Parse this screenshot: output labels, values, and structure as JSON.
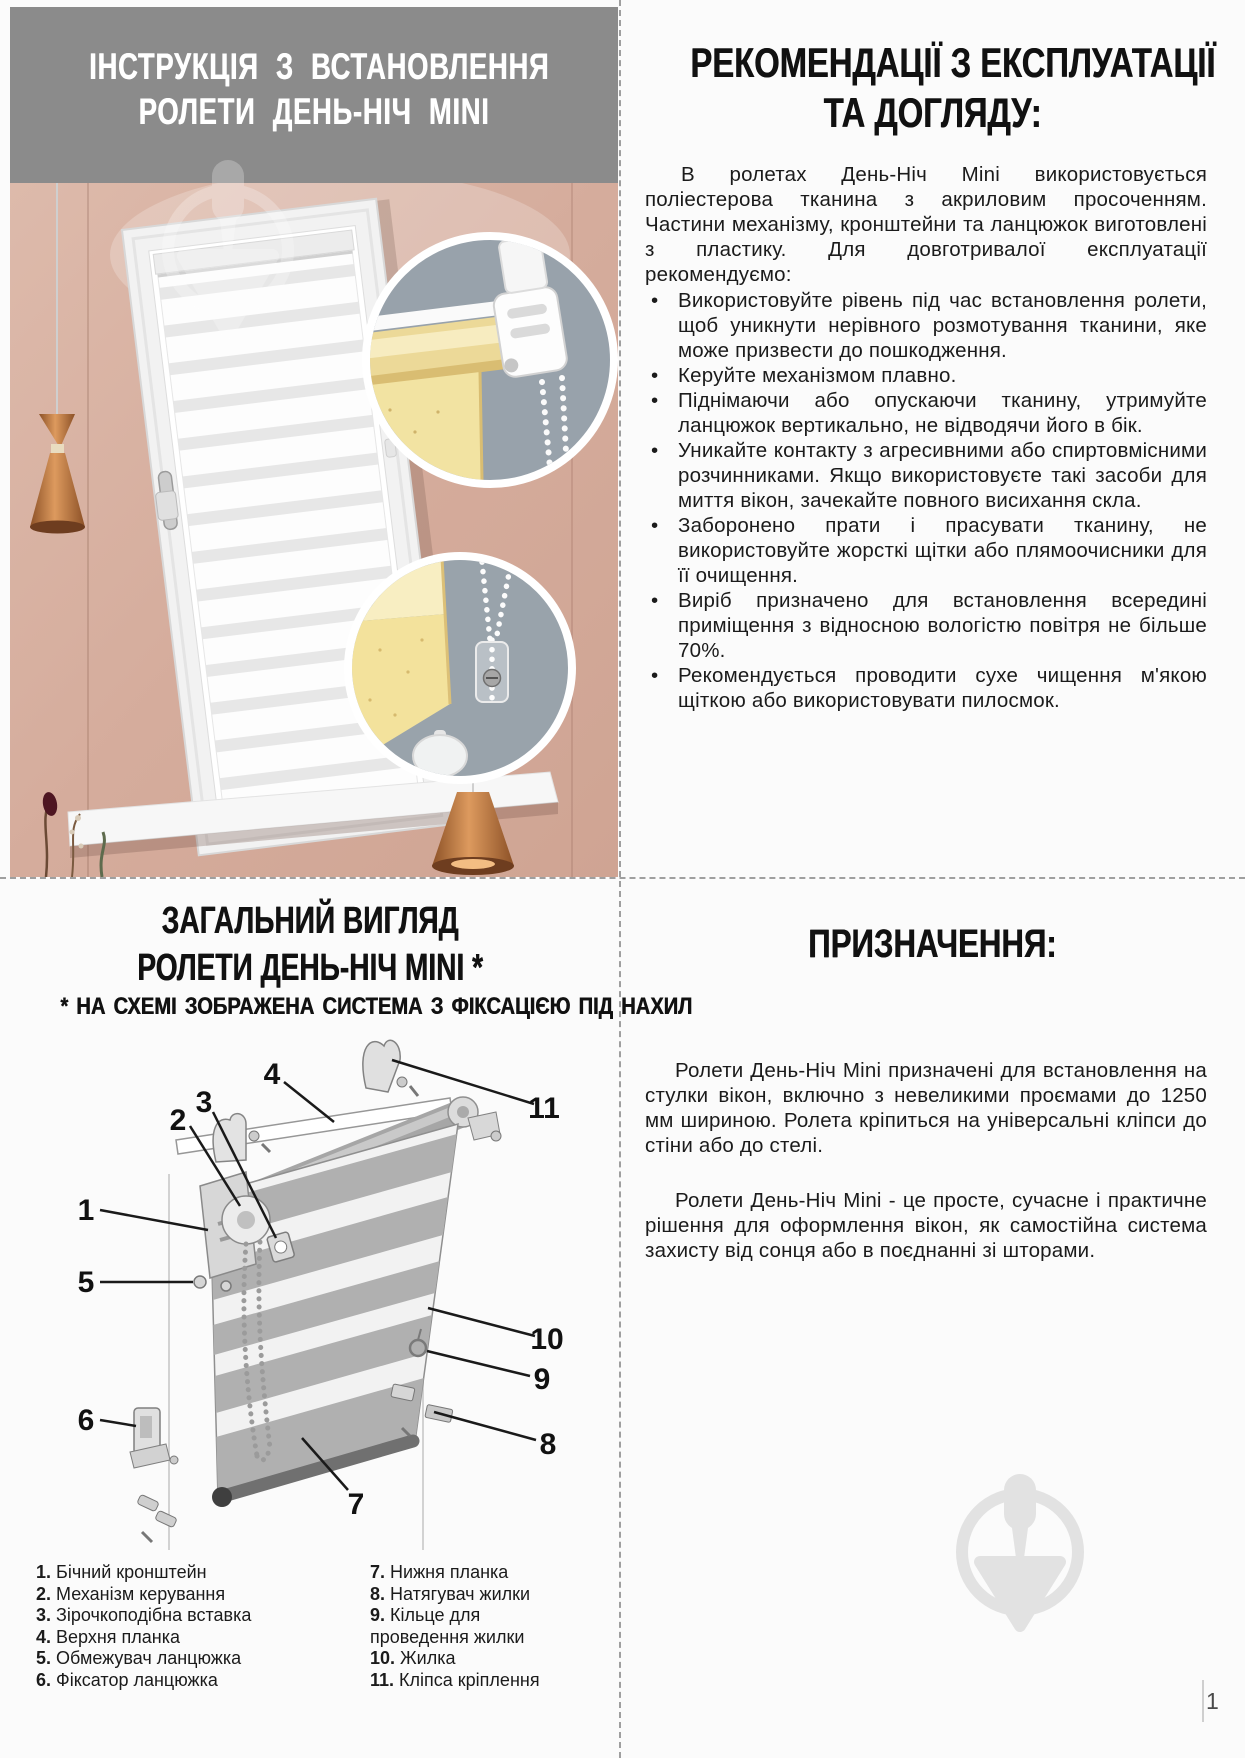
{
  "page": {
    "number": "1"
  },
  "colors": {
    "header_band_gray": "#8b8b8b",
    "wall_pink": "#d8b3a4",
    "inset_circle_gray": "#98a2ab",
    "blind_yellow": "#f3e29c",
    "watermark_gray": "#e2e2e2"
  },
  "photo": {
    "title_line1": "ІНСТРУКЦІЯ З ВСТАНОВЛЕННЯ",
    "title_line2": "РОЛЕТИ ДЕНЬ-НІЧ MINI"
  },
  "care": {
    "title_line1": "РЕКОМЕНДАЦІЇ З ЕКСПЛУАТАЦІЇ",
    "title_line2": "ТА ДОГЛЯДУ:",
    "intro": "В ролетах День-Ніч Mini використовується поліестерова тканина з акриловим просоченням. Частини механізму, кронштейни та ланцюжок виготовлені з пластику. Для довготривалої експлуатації рекомендуємо:",
    "bullets": [
      "Використовуйте рівень під час встановлення ролети, щоб уникнути нерівного розмотування тканини, яке може призвести до пошкодження.",
      "Керуйте механізмом плавно.",
      "Піднімаючи або опускаючи тканину, утримуйте ланцюжок вертикально, не відводячи його в бік.",
      "Уникайте контакту з агресивними або спиртовмісними розчинниками. Якщо використовуєте такі засоби для миття вікон, зачекайте повного висихання скла.",
      "Заборонено прати і прасувати тканину, не використовуйте жорсткі щітки або плямоочисники для її очищення.",
      "Виріб призначено для встановлення всередині приміщення з відносною вологістю повітря не більше 70%.",
      "Рекомендується проводити сухе чищення м'якою щіткою або використовувати пилосмок."
    ]
  },
  "overview": {
    "title_line1": "ЗАГАЛЬНИЙ ВИГЛЯД",
    "title_line2": "РОЛЕТИ ДЕНЬ-НІЧ MINI *",
    "subtitle": "* НА СХЕМІ ЗОБРАЖЕНА СИСТЕМА З ФІКСАЦІЄЮ ПІД НАХИЛ",
    "callouts": [
      "1",
      "2",
      "3",
      "4",
      "5",
      "6",
      "7",
      "8",
      "9",
      "10",
      "11"
    ],
    "legend_left": [
      {
        "num": "1.",
        "text": "Бічний кронштейн"
      },
      {
        "num": "2.",
        "text": "Механізм керування"
      },
      {
        "num": "3.",
        "text": "Зірочкоподібна вставка"
      },
      {
        "num": "4.",
        "text": "Верхня планка"
      },
      {
        "num": "5.",
        "text": "Обмежувач ланцюжка"
      },
      {
        "num": "6.",
        "text": "Фіксатор ланцюжка"
      }
    ],
    "legend_right": [
      {
        "num": "7.",
        "text": "Нижня планка"
      },
      {
        "num": "8.",
        "text": "Натягувач жилки"
      },
      {
        "num": "9.",
        "text": "Кільце для проведення жилки"
      },
      {
        "num": "10.",
        "text": "Жилка"
      },
      {
        "num": "11.",
        "text": "Кліпса кріплення"
      }
    ]
  },
  "purpose": {
    "title": "ПРИЗНАЧЕННЯ:",
    "paragraphs": [
      "Ролети День-Ніч Mini призначені для встановлення на стулки вікон, включно з невеликими проємами до 1250 мм шириною. Ролета кріпиться на універсальні кліпси до стіни або до стелі.",
      "Ролети День-Ніч Mini - це просте, сучасне і практичне рішення для оформлення вікон, як самостійна система захисту від сонця або в поєднанні зі шторами."
    ]
  }
}
